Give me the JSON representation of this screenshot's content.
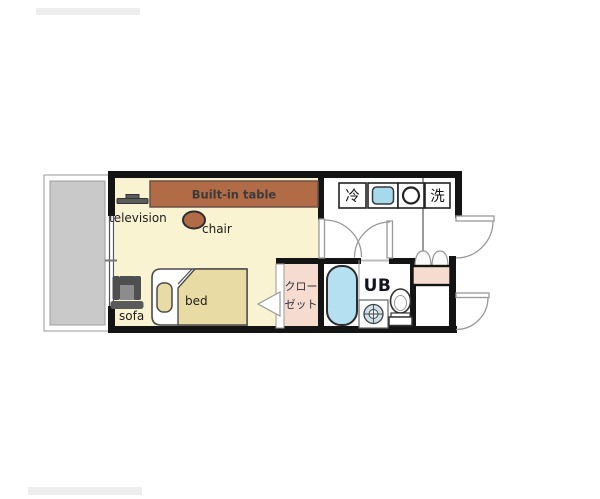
{
  "floorplan": {
    "main_room": {
      "television_label": "television",
      "table_label": "Built-in table",
      "chair_label": "chair",
      "sofa_label": "sofa",
      "bed_label": "bed"
    },
    "closet": {
      "label_line1": "クロー",
      "label_line2": "ゼット"
    },
    "kitchen": {
      "refrigerator_label": "冷",
      "washer_label": "洗"
    },
    "bathroom": {
      "unit_bath_label": "UB"
    }
  },
  "colors": {
    "wall": "#141414",
    "room_floor": "#faf3d2",
    "balcony": "#c9c9c9",
    "furniture_brown": "#b16b46",
    "closet_pink": "#f6dcce",
    "bathtub_blue": "#b5e0f2",
    "sink_blue": "#a7d9ec",
    "door_line": "#999999"
  }
}
